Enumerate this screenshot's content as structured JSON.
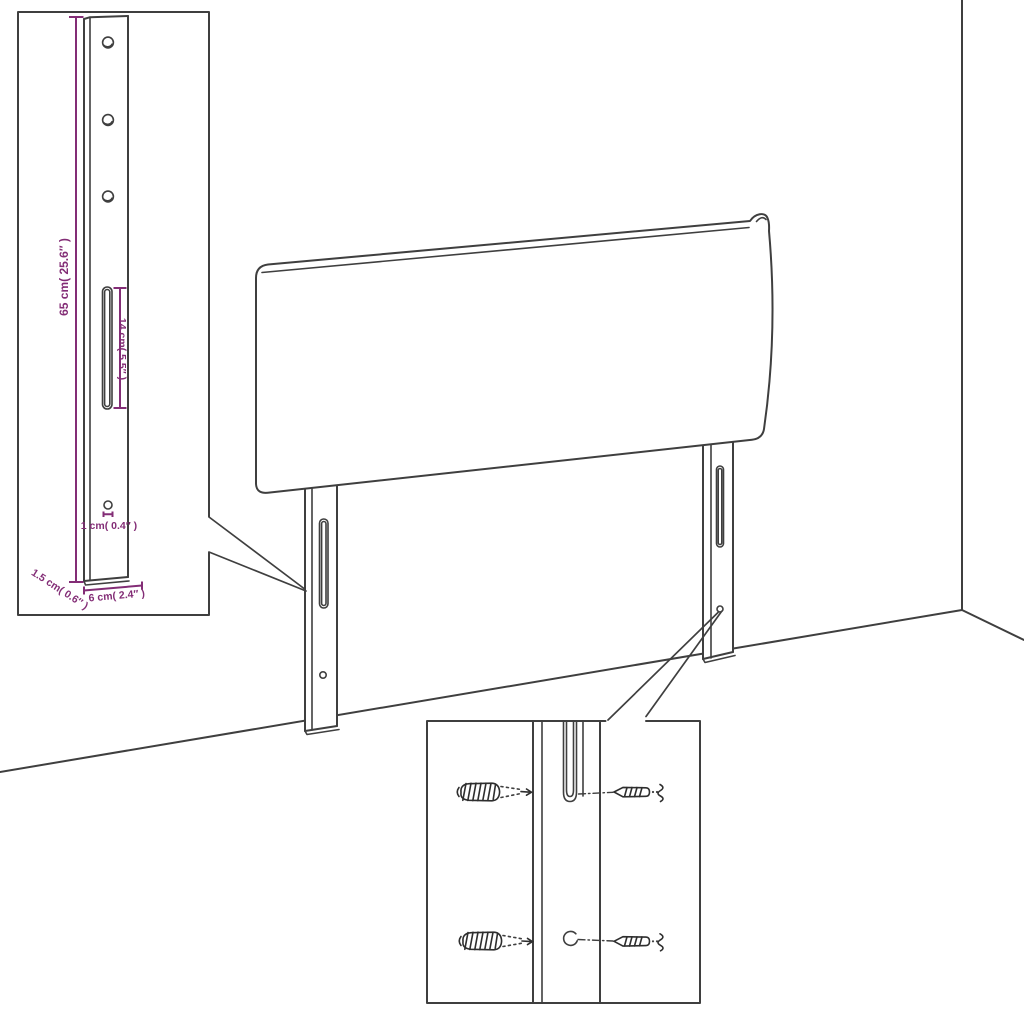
{
  "colors": {
    "line_art": "#3f3f3f",
    "dimension_accent": "#832d76",
    "background": "#ffffff"
  },
  "leg_detail_inset": {
    "height_label": "65 cm( 25.6″ )",
    "slot_length_label": "14 cm( 5.5″ )",
    "hole_diameter_label": "1 cm( 0.4″ )",
    "thickness_label": "1.5 cm( 0.6″ )",
    "width_label": "6 cm( 2.4″ )"
  }
}
